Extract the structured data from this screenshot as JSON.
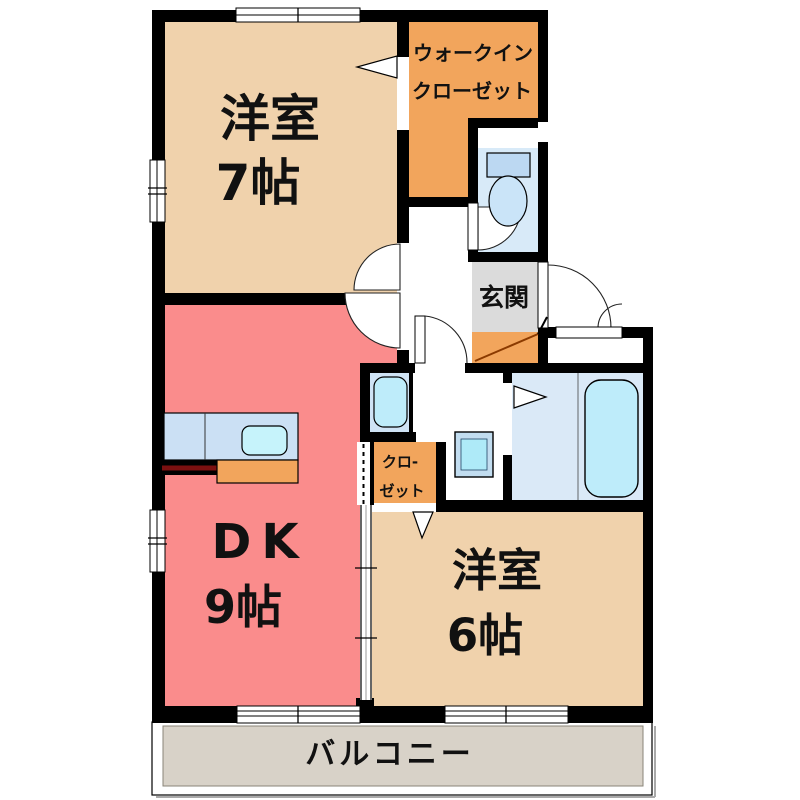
{
  "plan_title": "1DK apartment floor plan",
  "colors": {
    "wall": "#000000",
    "room_beige": "#F0D2AC",
    "room_pink": "#FA8C8C",
    "room_orange": "#F2A55C",
    "genkan_gray": "#DBDBDB",
    "balcony_gray": "#D8D2C8",
    "toilet_blue": "#D8EAF8",
    "bath_blue": "#DAE9F7",
    "washer_blue": "#CFE3F5",
    "counter_blue": "#CBE0F4",
    "fixture_cyan": "#BEECFA",
    "sink_cyan": "#C6F3FB",
    "tank_blue": "#BCD8F2",
    "bowl_blue": "#CAE4F8",
    "basin_frame": "#C2DDF0",
    "basin_inner": "#AEEAF8",
    "step_line": "#8B3A00",
    "counter_stub_line": "#7B1010"
  },
  "rooms": {
    "western_room_7": {
      "label_line1": "洋室",
      "label_line2": "7帖"
    },
    "walk_in_closet": {
      "label_line1": "ウォークイン",
      "label_line2": "クローゼット"
    },
    "genkan": {
      "label": "玄関"
    },
    "dk": {
      "label_line1": "DK",
      "label_line2": "9帖"
    },
    "closet": {
      "label_line1": "クロ-",
      "label_line2": "ゼット"
    },
    "western_room_6": {
      "label_line1": "洋室",
      "label_line2": "6帖"
    },
    "balcony": {
      "label": "バルコニー"
    }
  }
}
